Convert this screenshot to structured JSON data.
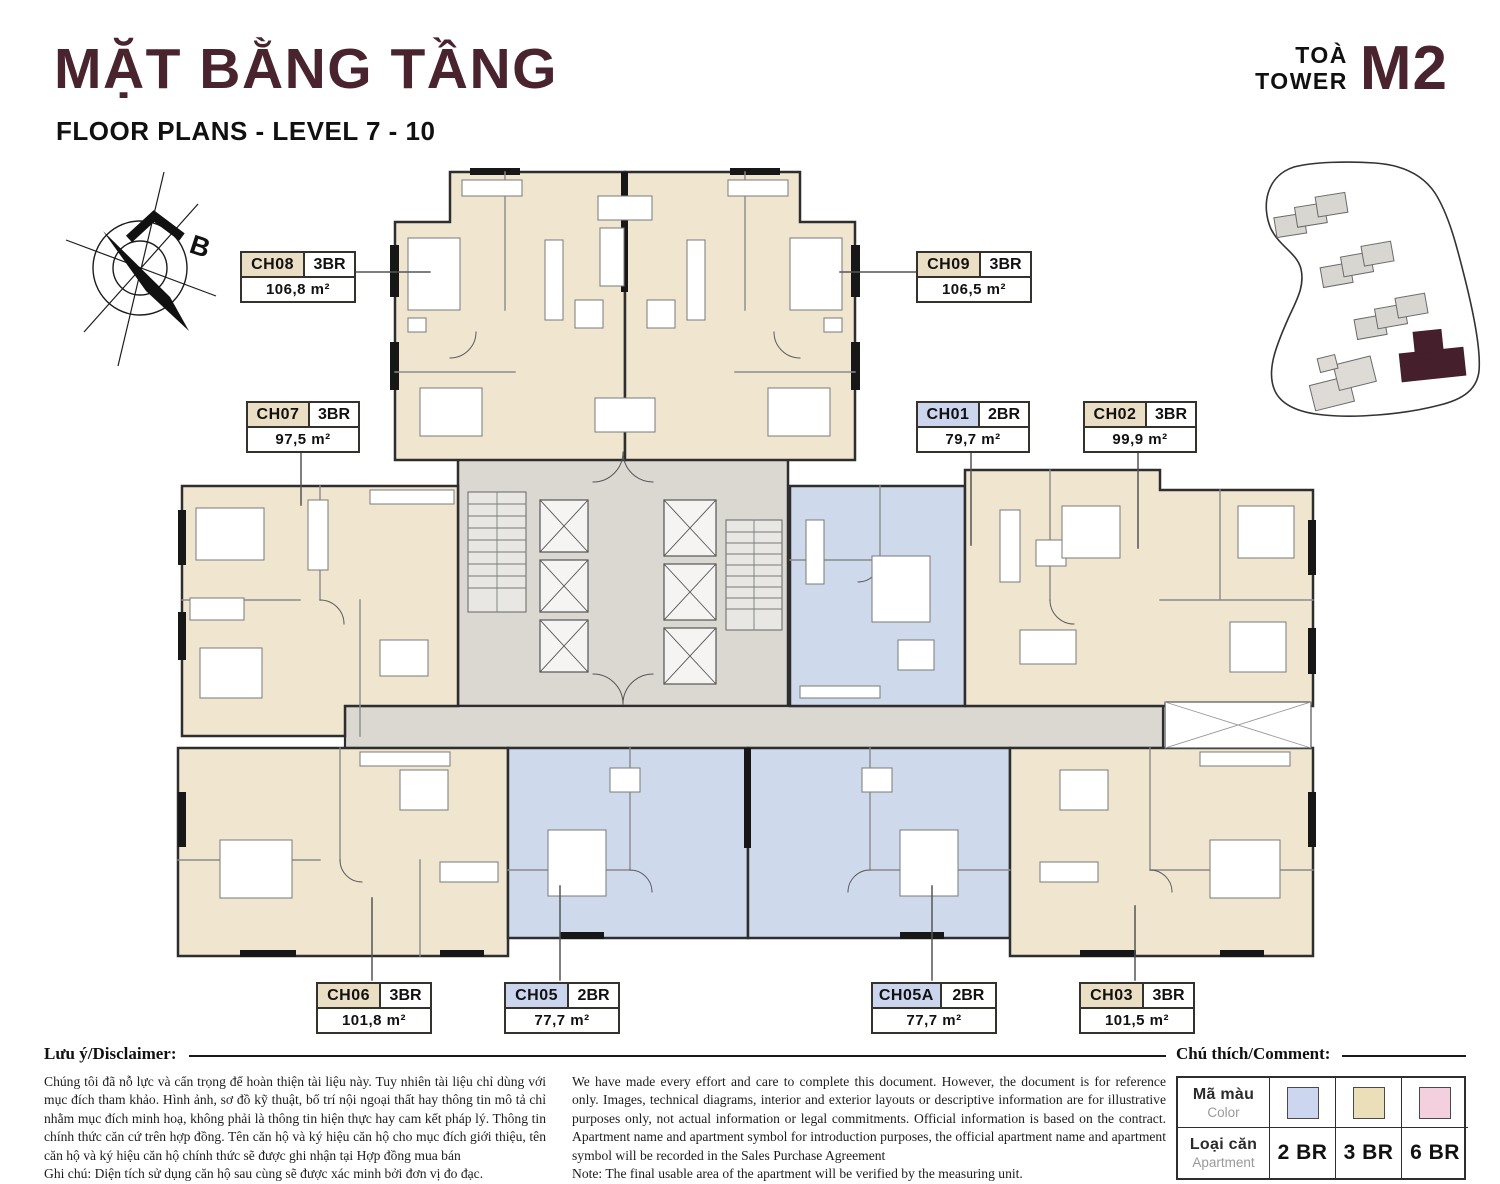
{
  "header": {
    "title": "MẶT BẰNG TẦNG",
    "subtitle": "FLOOR PLANS - LEVEL 7 - 10",
    "tower_prefix_vi": "TOÀ",
    "tower_prefix_en": "TOWER",
    "tower_code": "M2"
  },
  "compass": {
    "north_label": "B"
  },
  "apartments": [
    {
      "code": "CH08",
      "type": "3BR",
      "area": "106,8 m²",
      "badge_color": "#eadec4"
    },
    {
      "code": "CH09",
      "type": "3BR",
      "area": "106,5 m²",
      "badge_color": "#eadec4"
    },
    {
      "code": "CH07",
      "type": "3BR",
      "area": "97,5 m²",
      "badge_color": "#eadec4"
    },
    {
      "code": "CH01",
      "type": "2BR",
      "area": "79,7 m²",
      "badge_color": "#cbd6ee"
    },
    {
      "code": "CH02",
      "type": "3BR",
      "area": "99,9 m²",
      "badge_color": "#eadec4"
    },
    {
      "code": "CH06",
      "type": "3BR",
      "area": "101,8 m²",
      "badge_color": "#eadec4"
    },
    {
      "code": "CH05",
      "type": "2BR",
      "area": "77,7 m²",
      "badge_color": "#cbd6ee"
    },
    {
      "code": "CH05A",
      "type": "2BR",
      "area": "77,7 m²",
      "badge_color": "#cbd6ee"
    },
    {
      "code": "CH03",
      "type": "3BR",
      "area": "101,5 m²",
      "badge_color": "#eadec4"
    }
  ],
  "disclaimer": {
    "heading": "Lưu ý/Disclaimer:",
    "vi": "Chúng tôi đã nỗ lực và cẩn trọng để hoàn thiện tài liệu này. Tuy nhiên tài liệu chỉ dùng với mục đích tham khảo. Hình ảnh, sơ đồ kỹ thuật, bố trí nội ngoại thất hay thông tin mô tả chỉ nhằm mục đích minh hoạ, không phải là thông tin hiện thực hay cam kết pháp lý. Thông tin chính thức căn cứ trên hợp đồng. Tên căn hộ và ký hiệu căn hộ cho mục đích giới thiệu, tên căn hộ và ký hiệu căn hộ chính thức sẽ được ghi nhận tại Hợp đồng mua bán",
    "vi_note": "Ghi chú: Diện tích sử dụng căn hộ sau cùng sẽ được xác minh bởi đơn vị đo đạc.",
    "en": "We have made every effort and care to complete this document. However, the document is for reference only. Images, technical diagrams, interior and exterior layouts or descriptive information are for illustrative purposes only, not actual information or legal commitments. Official information is based on the contract. Apartment name and apartment symbol for introduction purposes, the official apartment name and apartment symbol will be recorded in the Sales Purchase Agreement",
    "en_note": "Note: The final usable area of the apartment will be verified by the measuring unit."
  },
  "legend": {
    "heading": "Chú thích/Comment:",
    "color_label_vi": "Mã màu",
    "color_label_en": "Color",
    "type_label_vi": "Loại căn",
    "type_label_en": "Apartment",
    "items": [
      {
        "label": "2 BR",
        "color": "#ccd6ef"
      },
      {
        "label": "3 BR",
        "color": "#eadfb8"
      },
      {
        "label": "6 BR",
        "color": "#f4d0de"
      }
    ]
  },
  "colors": {
    "accent": "#49242f",
    "apartment_3br_fill": "#f0e6d0",
    "apartment_2br_fill": "#cfd9ec",
    "core_fill": "#dbd8d2",
    "wall": "#2e2e2e"
  }
}
